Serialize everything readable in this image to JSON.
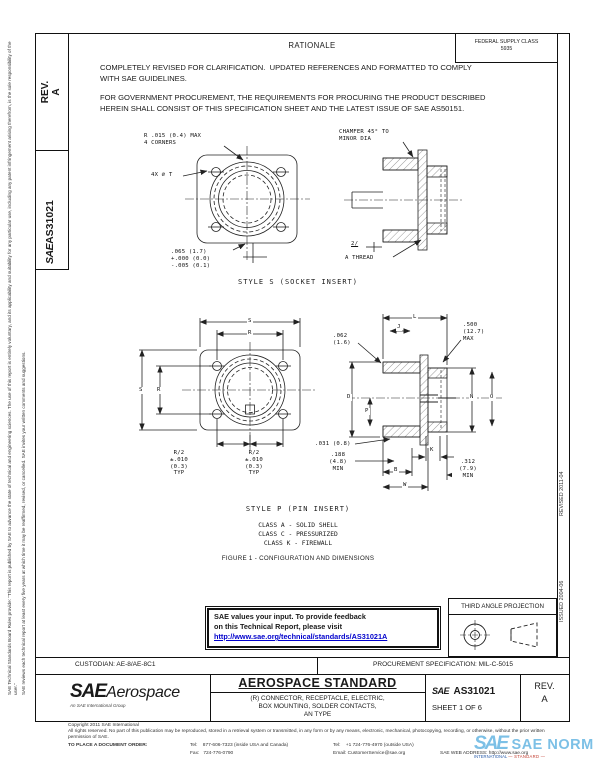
{
  "side_tabs": {
    "rev_label": "REV.",
    "rev_value": "A",
    "sae": "SAE",
    "doc_number": "AS31021"
  },
  "margins": {
    "disclaimer_1": "SAE Technical Standards Board Rules provide: \"This report is published by SAE to advance the state of technical and engineering sciences. The use of this report is entirely voluntary, and its applicability and suitability for any particular use, including any patent infringement arising therefrom, is the sole responsibility of the user.\"",
    "disclaimer_2": "SAE reviews each technical report at least every five years at which time it may be reaffirmed, revised, or cancelled. SAE invites your written comments and suggestions.",
    "revised": "REVISED 2011-04",
    "issued": "ISSUED 2004-06"
  },
  "header": {
    "fsc": "FEDERAL SUPPLY CLASS\n5935",
    "rationale_title": "RATIONALE",
    "para1": "COMPLETELY REVISED FOR CLARIFICATION.  UPDATED REFERENCES AND FORMATTED TO COMPLY\nWITH SAE GUIDELINES.",
    "para2": "FOR GOVERNMENT PROCUREMENT, THE REQUIREMENTS FOR PROCURING THE PRODUCT DESCRIBED\nHEREIN SHALL CONSIST OF THIS SPECIFICATION SHEET AND THE LATEST ISSUE OF SAE AS50151."
  },
  "figure1": {
    "labels": {
      "corner_radius": "R .015 (0.4) MAX\n4 CORNERS",
      "holes": "4X ∅ T",
      "flange_thickness": ".065 (1.7)\n+.000 (0.0)\n-.005 (0.1)",
      "chamfer": "CHAMFER 45° TO\nMINOR DIA",
      "note_flag": "2/",
      "thread": "A THREAD"
    },
    "caption": "STYLE S (SOCKET INSERT)"
  },
  "figure2": {
    "labels": {
      "dim_s_top": "S",
      "dim_r_top": "R",
      "dim_s_left": "S",
      "dim_r_left": "R",
      "r2_left": "R/2\n±.010\n(0.3)\nTYP",
      "r2_right": "R/2\n±.010\n(0.3)\nTYP",
      "dim_l": "L",
      "dim_j": "J",
      "wall": ".062\n(1.6)",
      "max_depth": ".500\n(12.7)\nMAX",
      "dim_d": "D",
      "dim_p": "P",
      "dim_n": "N",
      "dim_o": "O",
      "key_width": ".031 (0.8)",
      "min_thread": ".188\n(4.8)\nMIN",
      "dim_b": "B",
      "dim_w": "W",
      "dim_k": "K",
      "min_engage": ".312\n(7.9)\nMIN"
    },
    "caption": "STYLE P (PIN INSERT)"
  },
  "notes": {
    "classes": "CLASS A - SOLID SHELL\nCLASS C - PRESSURIZED\nCLASS K - FIREWALL",
    "figure_caption": "FIGURE 1 - CONFIGURATION AND DIMENSIONS"
  },
  "feedback": {
    "line1": "SAE values your input. To provide feedback",
    "line2": "on this Technical Report, please visit",
    "link": "http://www.sae.org/technical/standards/AS31021A"
  },
  "projection": {
    "title": "THIRD ANGLE PROJECTION"
  },
  "title_block": {
    "custodian": "CUSTODIAN: AE-8/AE-8C1",
    "procurement": "PROCUREMENT SPECIFICATION: MIL-C-5015",
    "logo_sae": "SAE",
    "logo_aerospace": "Aerospace",
    "logo_tagline": "An SAE International Group",
    "doc_type": "AEROSPACE STANDARD",
    "title": "(R) CONNECTOR, RECEPTACLE, ELECTRIC,\nBOX MOUNTING, SOLDER CONTACTS,\nAN TYPE",
    "number_prefix": "SAE",
    "number": "AS31021",
    "sheet": "SHEET 1 OF 6",
    "rev_label": "REV.",
    "rev_value": "A"
  },
  "footer": {
    "copyright": "Copyright 2011 SAE International",
    "rights": "All rights reserved. No part of this publication may be reproduced, stored in a retrieval system or transmitted, in any form or by any means, electronic, mechanical, photocopying, recording, or otherwise, without the prior written permission of SAE.",
    "order_label": "TO PLACE A DOCUMENT ORDER:",
    "tel_inside": "Tel:    877-606-7323 (inside USA and Canada)",
    "fax": "Fax:   724-776-0790",
    "tel_outside": "Tel:    +1 724-776-4970 (outside USA)",
    "email": "Email: CustomerService@sae.org",
    "web": "SAE WEB ADDRESS: http://www.sae.org"
  },
  "watermark": {
    "logo": "SAE",
    "text": "SAE NORM",
    "sub_left": "INTERNATIONAL",
    "sub_right": "STANDARD",
    "color": "#7cc0e6"
  }
}
